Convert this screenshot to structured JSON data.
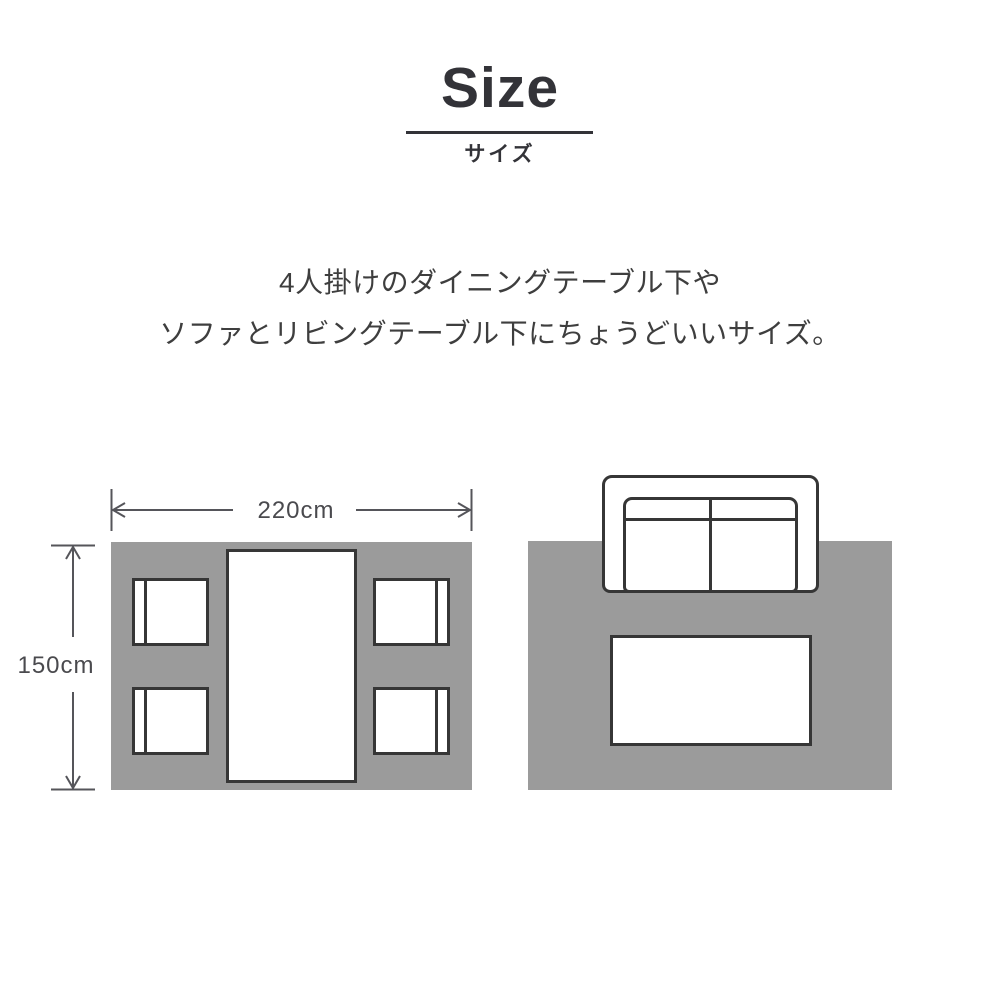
{
  "header": {
    "title": "Size",
    "subtitle_ja": "サイズ"
  },
  "description": {
    "line1": "4人掛けのダイニングテーブル下や",
    "line2": "ソファとリビングテーブル下にちょうどいいサイズ。"
  },
  "rug": {
    "width_label": "220cm",
    "height_label": "150cm"
  },
  "icons": {
    "dining_set": "dining-table-with-four-chairs-top-view",
    "sofa": "two-seat-sofa-top-view",
    "living_table": "living-table-top-view",
    "width_arrow": "double-headed-horizontal-arrow",
    "height_arrow": "double-headed-vertical-arrow"
  },
  "colors": {
    "rug_fill": "#9b9b9b",
    "furniture_outline": "#363636",
    "dimension_line": "#55555a",
    "body_text": "#3e3e3e",
    "title_text": "#333338",
    "background": "#ffffff"
  }
}
